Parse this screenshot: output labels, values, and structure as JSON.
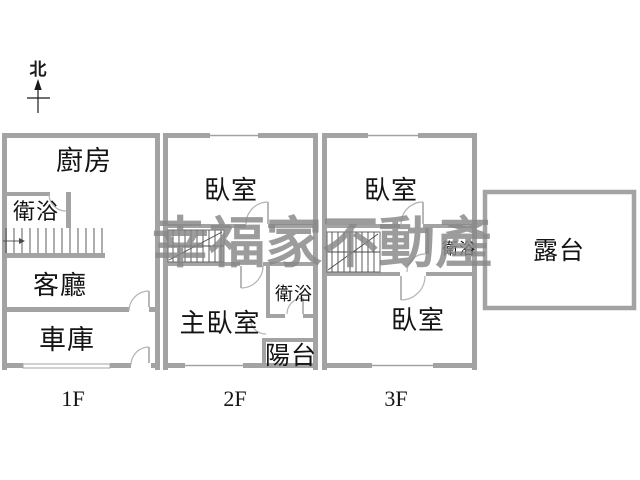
{
  "page": {
    "background": "#ffffff"
  },
  "colors": {
    "wall": "#a3a3a3",
    "stair": "#4a4a4a",
    "door_arc": "#b4b4b4",
    "text": "#141414",
    "watermark": "#878787"
  },
  "north": {
    "label": "北"
  },
  "watermark": {
    "text": "幸福家不動產"
  },
  "floors": [
    {
      "label": "1F",
      "rooms": {
        "kitchen": "廚房",
        "bathroom": "衛浴",
        "living_room": "客廳",
        "garage": "車庫"
      }
    },
    {
      "label": "2F",
      "rooms": {
        "bedroom": "臥室",
        "master_bedroom": "主臥室",
        "bathroom": "衛浴",
        "balcony": "陽台"
      }
    },
    {
      "label": "3F",
      "rooms": {
        "bedroom_front": "臥室",
        "bathroom": "衛浴",
        "bedroom_back": "臥室"
      }
    }
  ],
  "terrace": {
    "label": "露台"
  }
}
